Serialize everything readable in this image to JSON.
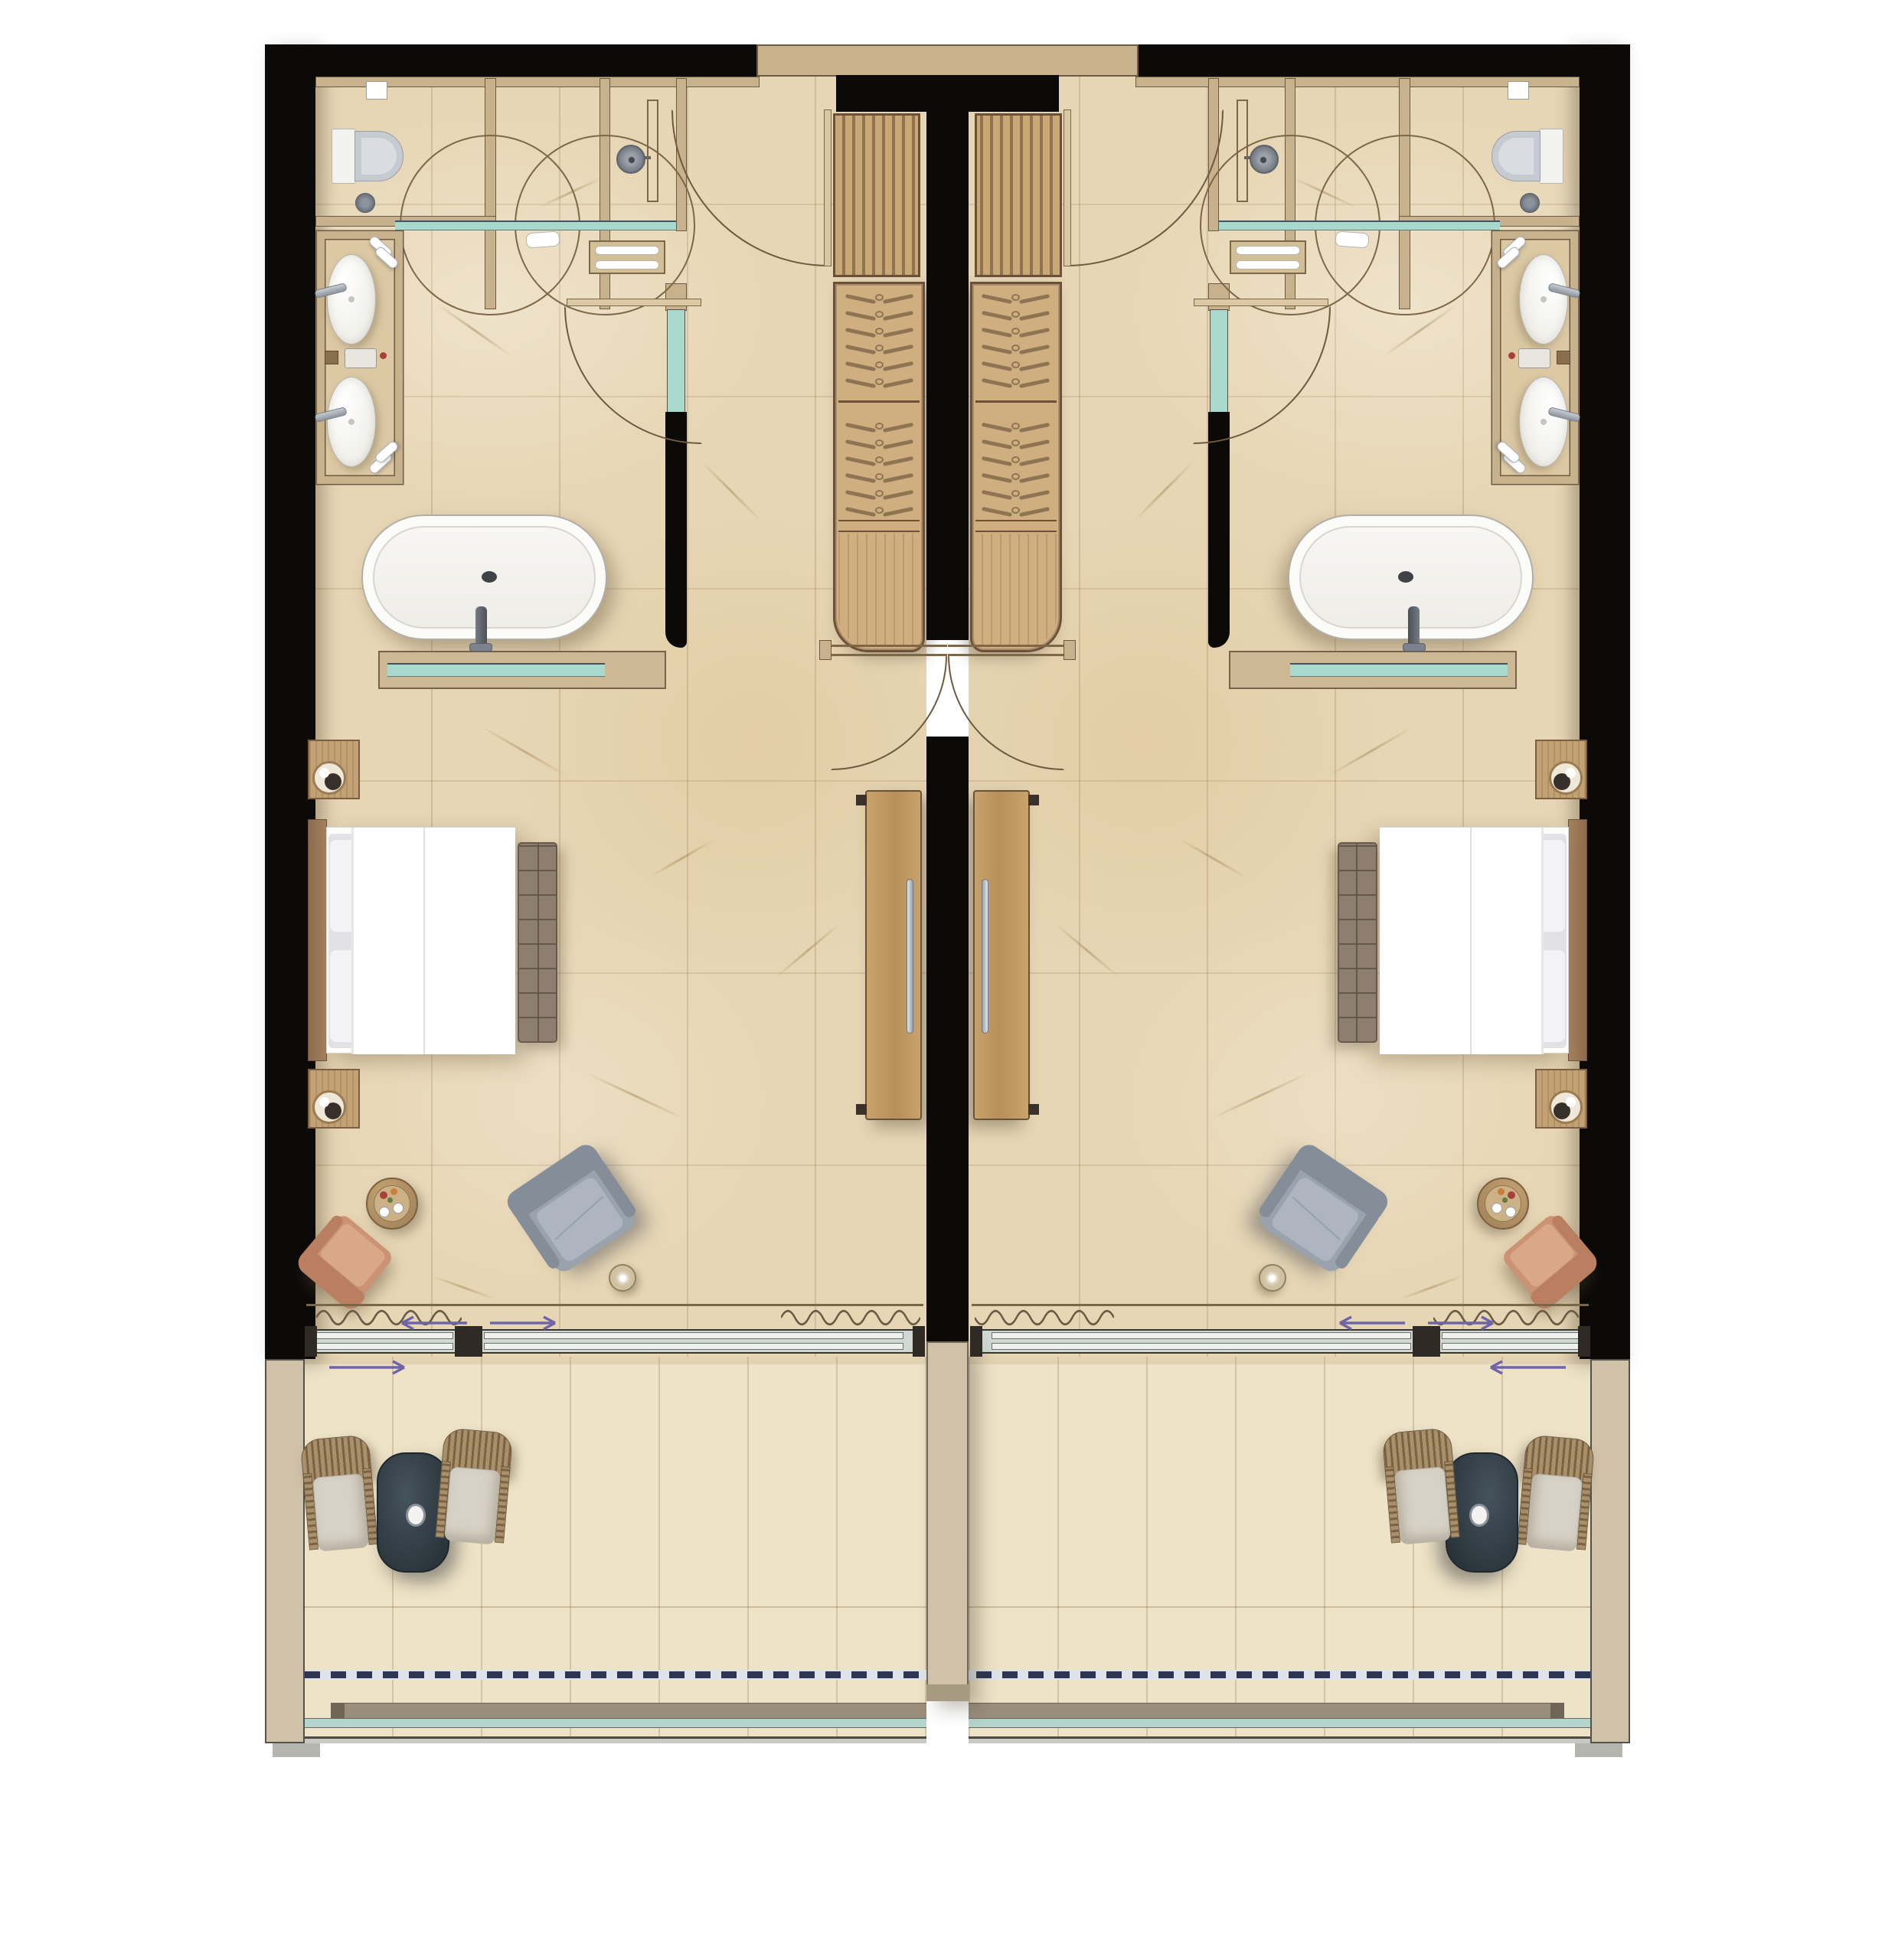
{
  "document": {
    "type": "architectural-floor-plan",
    "description": "Top-view rendered floor plan of two mirrored hotel guest rooms separated by a central party wall. Each room has an entry with swing door, slatted luggage bench, wardrobe with hangers, bathroom zone (WC cubicle with wall-hung toilet, two circular pivot glass doors, walk-in shower, teal glass partition, twin-basin vanity niche, freestanding oval bathtub with glass half-wall), bedroom (bed with headboard and foot bench, two nightstands with lamps, terracotta armchair, round drinks table, gray lounge chair, floor lamp, wall-mounted TV panel), full-width sliding glass wall with curtain, and a private balcony with two wicker chairs, dark outdoor table, roof-overhang dashed line and teal glass balustrade.",
    "visible_text": []
  },
  "palette": {
    "wall_black": "#0b0a09",
    "wall_tan": "#c8b28d",
    "wall_edge": "#6e5a40",
    "floor_marble": "#e7d6b4",
    "floor_balcony": "#eee3c7",
    "wood": "#cfae80",
    "wood_dark": "#6b5139",
    "wood_mid": "#8f7454",
    "glass_teal": "#a9d8cc",
    "glass_frame": "#54504a",
    "porcelain": "#fbfbf9",
    "seat_gray": "#c6cbd2",
    "bed_white": "#fdfdfc",
    "pillow": "#e2e2e6",
    "headboard": "#9c7a56",
    "bench": "#8e7e6f",
    "chair_gray": "#9aa2ac",
    "chair_gray_dark": "#848d98",
    "chair_terracotta": "#cb9374",
    "chair_terracotta_dark": "#b97f60",
    "side_table": "#b9996c",
    "lamp_beige": "#cfc1a1",
    "balcony_table": "#323e46",
    "wicker": "#a8906b",
    "wicker_dark": "#7b6243",
    "cushion": "#d8d2c6",
    "arrow": "#6f64a8",
    "dash_navy": "#2c3654",
    "rail_teal": "#b5d4cb",
    "band_gray": "#9a8e7b",
    "divider_tan": "#cfc2a8",
    "metal": "#aab2ba"
  },
  "rooms": {
    "count": 2,
    "mirrored": true,
    "labels": [
      "room-left",
      "room-right"
    ]
  },
  "wardrobe": {
    "hanger_sections": 2,
    "hangers_per_section": 6,
    "lower_shelf_sections": 1
  },
  "bathroom_fixtures": [
    "wall-hung-toilet",
    "cistern-button",
    "floor-drain",
    "pivot-glass-door-circle-1",
    "pivot-glass-door-circle-2",
    "teal-glass-partition",
    "shower-head",
    "shower-rail",
    "towel-shelf",
    "vanity-sink-1",
    "vanity-sink-2",
    "sink-faucet-2x",
    "towel-roll-4x",
    "amenity-tray",
    "freestanding-bathtub",
    "tub-faucet",
    "glass-half-wall-ledge",
    "bath-door"
  ],
  "bedroom_furniture": [
    "headboard",
    "double-bed",
    "pillows",
    "duvet",
    "tufted-foot-bench",
    "nightstand-2x",
    "table-lamp-2x",
    "terracotta-armchair",
    "round-side-table",
    "drinks-tray",
    "gray-lounge-chair",
    "floor-lamp",
    "tv-panel-with-handle",
    "curtain-wave",
    "sliding-glass-wall"
  ],
  "balcony_furniture": [
    "wicker-chair-2x",
    "dark-outdoor-table",
    "parasol-hole",
    "glass-balustrade",
    "roof-overhang-dashed-line"
  ],
  "annotations": {
    "slide_direction_arrows_per_room": 3,
    "arrow_color": "#6f64a8"
  }
}
